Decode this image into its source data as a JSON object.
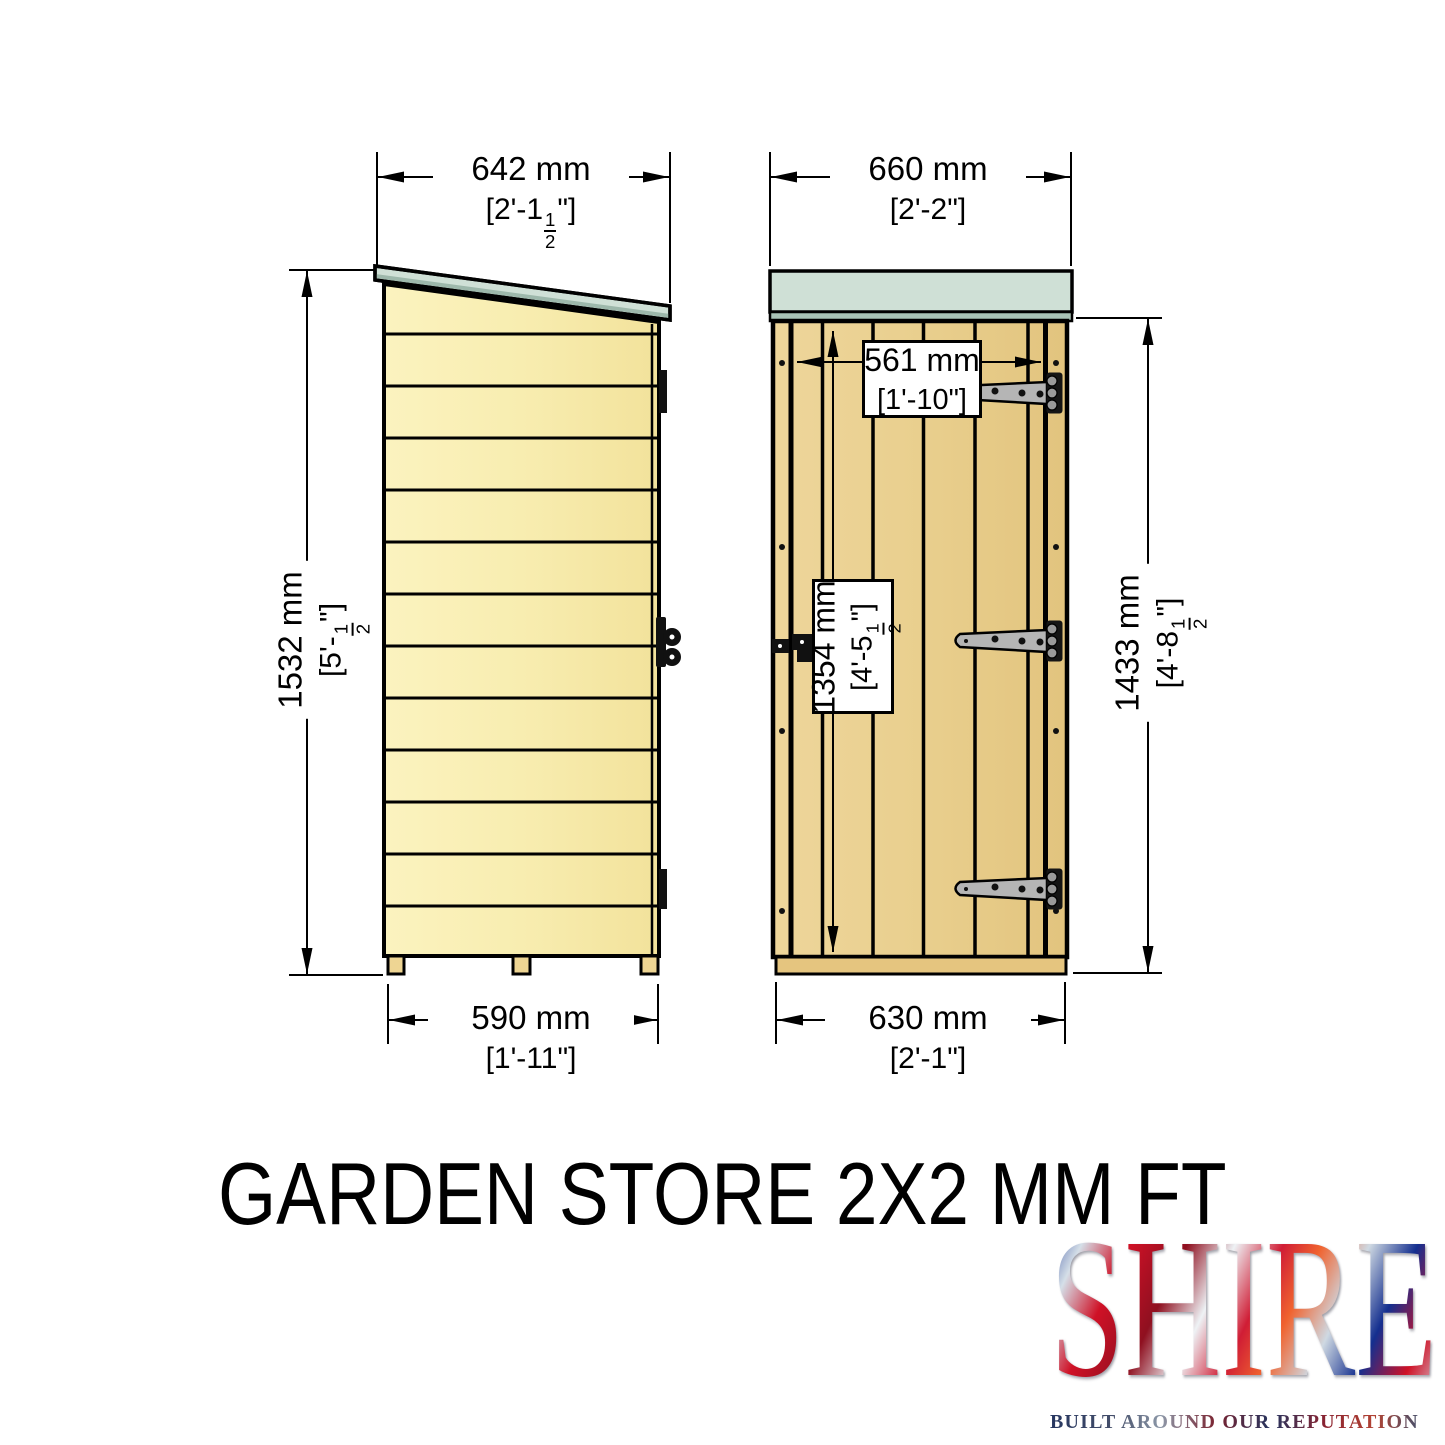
{
  "title": "GARDEN STORE 2X2 MM FT",
  "logo": {
    "brand": "SHIRE",
    "tagline": "BUILT AROUND OUR REPUTATION"
  },
  "dimensions": {
    "side_roof_width": {
      "mm": "642 mm",
      "imp_pre": "[2'-1",
      "imp_num": "1",
      "imp_den": "2",
      "imp_post": "\"]"
    },
    "front_roof_width": {
      "mm": "660 mm",
      "imp_pre": "[2'-2\"]",
      "imp_num": "",
      "imp_den": "",
      "imp_post": ""
    },
    "side_height": {
      "mm": "1532 mm",
      "imp_pre": "[5'-",
      "imp_num": "1",
      "imp_den": "2",
      "imp_post": "\"]"
    },
    "door_width": {
      "mm": "561 mm",
      "imp_pre": "[1'-10\"]",
      "imp_num": "",
      "imp_den": "",
      "imp_post": ""
    },
    "door_height": {
      "mm": "1354 mm",
      "imp_pre": "[4'-5",
      "imp_num": "1",
      "imp_den": "2",
      "imp_post": "\"]"
    },
    "front_wall_height": {
      "mm": "1433 mm",
      "imp_pre": "[4'-8",
      "imp_num": "1",
      "imp_den": "2",
      "imp_post": "\"]"
    },
    "side_base_width": {
      "mm": "590 mm",
      "imp_pre": "[1'-11\"]",
      "imp_num": "",
      "imp_den": "",
      "imp_post": ""
    },
    "front_base_width": {
      "mm": "630 mm",
      "imp_pre": "[2'-1\"]",
      "imp_num": "",
      "imp_den": "",
      "imp_post": ""
    }
  },
  "colors": {
    "wall_side": "#f8edb0",
    "wall_front": "#e9cf8e",
    "roof": "#cfe0d6",
    "roof_fascia": "#a9c3b6",
    "hinge_strap": "#b5b5b5",
    "line": "#000000"
  }
}
